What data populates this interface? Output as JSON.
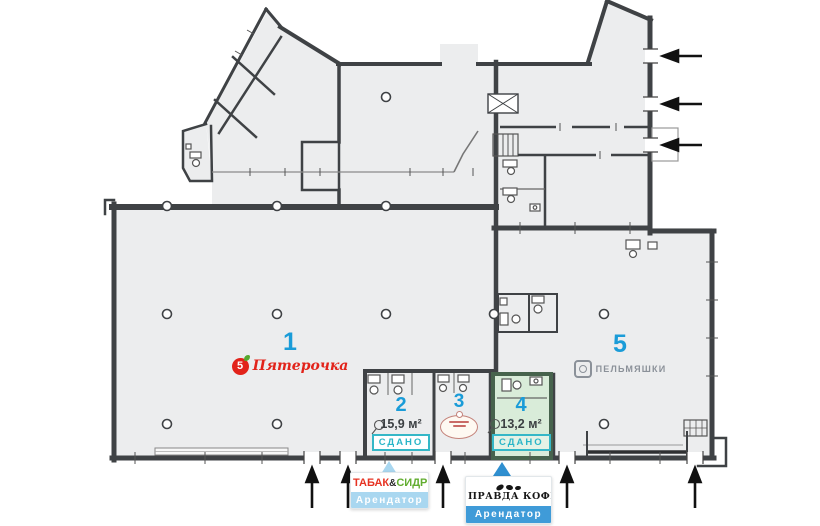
{
  "plan_labels": {
    "unit1": {
      "number": "1",
      "logo_glyph": "5",
      "tenant": "Пятерочка"
    },
    "unit2": {
      "number": "2",
      "area": "15,9 м²",
      "status": "СДАНО"
    },
    "unit3": {
      "number": "3"
    },
    "unit4": {
      "number": "4",
      "area": "13,2 м²",
      "status": "СДАНО"
    },
    "unit5": {
      "number": "5",
      "tenant": "ПЕЛЬМЯШКИ"
    }
  },
  "tenant_cards": {
    "card1": {
      "word1": "ТАБАК",
      "amp": "&",
      "word2": "СИДР",
      "subtitle": "Арендатор"
    },
    "card2": {
      "brand": "ПРАВДА КОФЕ",
      "subtitle": "Арендатор"
    }
  },
  "colors": {
    "unit_number_blue": "#1A9CD8",
    "status_teal": "#2AB5C8",
    "unit4_fill_green": "#D9ECD9",
    "pyaterochka_red": "#E2231A",
    "tabak_red": "#E63323",
    "sidr_green": "#62AD30",
    "arendator_light_blue": "#A9D7F0",
    "arendator_blue": "#3F9BD8",
    "unit5_logo_gray": "#8B9199",
    "wall_gray": "#3F4245",
    "floor_gray": "#ECEDEE"
  }
}
